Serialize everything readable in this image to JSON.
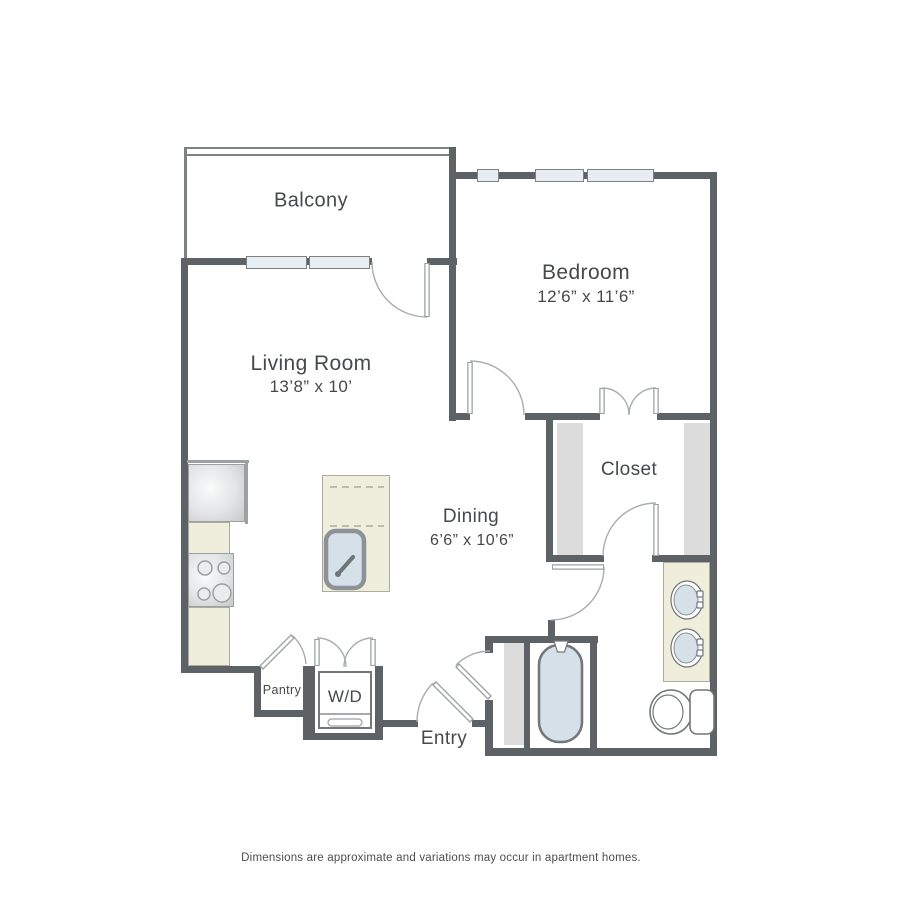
{
  "rooms": {
    "balcony": {
      "name": "Balcony"
    },
    "bedroom": {
      "name": "Bedroom",
      "dimensions": "12’6” x 11’6”"
    },
    "living_room": {
      "name": "Living Room",
      "dimensions": "13’8” x 10’"
    },
    "dining": {
      "name": "Dining",
      "dimensions": "6’6” x 10’6”"
    },
    "closet": {
      "name": "Closet"
    },
    "pantry": {
      "name": "Pantry"
    },
    "laundry": {
      "name": "W/D"
    },
    "entry": {
      "name": "Entry"
    }
  },
  "footer": {
    "disclaimer": "Dimensions are approximate and variations may occur in apartment homes."
  },
  "fixtures": [
    "refrigerator",
    "range",
    "kitchen-island-sink",
    "bathtub",
    "vanity-sink",
    "vanity-sink",
    "toilet",
    "washer-dryer"
  ],
  "colors": {
    "wall": "#5d6266",
    "rail": "#7e8285",
    "door": "#9aa0a4",
    "arc": "#a8adb1",
    "window_fill": "#e7edf2",
    "window_border": "#7c8185",
    "shade": "#dcdcdc",
    "counter": "#efeedd",
    "counter_border": "#acac9c",
    "fixture": "#73777b",
    "water": "#d5e0e9",
    "appliance_border": "#9ba0a3",
    "text": "#46494c",
    "footer_text": "#4b4e51"
  }
}
